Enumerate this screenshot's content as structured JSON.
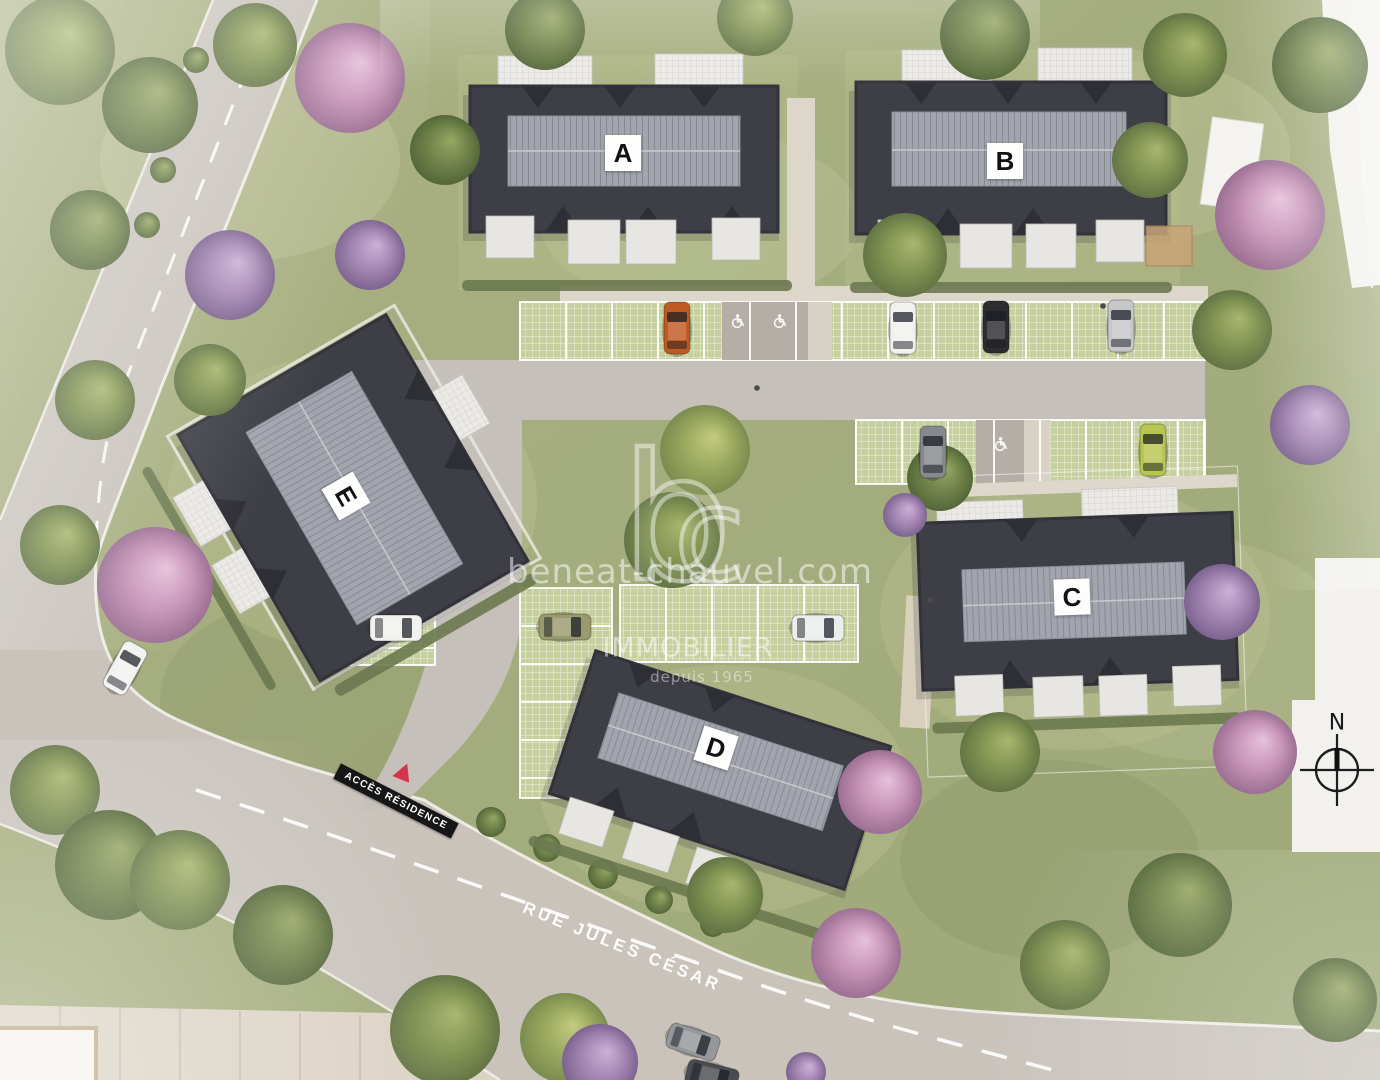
{
  "site_plan": {
    "buildings": [
      {
        "label": "A"
      },
      {
        "label": "B"
      },
      {
        "label": "C"
      },
      {
        "label": "D"
      },
      {
        "label": "E"
      }
    ],
    "watermark": {
      "logo_b": "b",
      "logo_c": "c",
      "website": "beneat-chauvel.com",
      "brand": "IMMOBILIER",
      "tagline": "depuis 1965"
    },
    "signs": {
      "residence_access": "ACCÈS RÉSIDENCE",
      "street_name": "RUE JULES CÉSAR",
      "compass_north": "N"
    },
    "colors": {
      "grass": "#a9b084",
      "road": "#c9c3bc",
      "sidewalk": "#dbd3c4",
      "roof_dark": "#3e3e46",
      "roof_ridge_light": "#a2a5ad",
      "paver_green": "#c6cf9e",
      "terrace_white": "#eceae6",
      "hedge_green": "#6c7950",
      "sign_background": "#161616",
      "sign_triangle_red": "#d6334c",
      "watermark_white": "rgba(255,255,255,0.5)"
    }
  }
}
